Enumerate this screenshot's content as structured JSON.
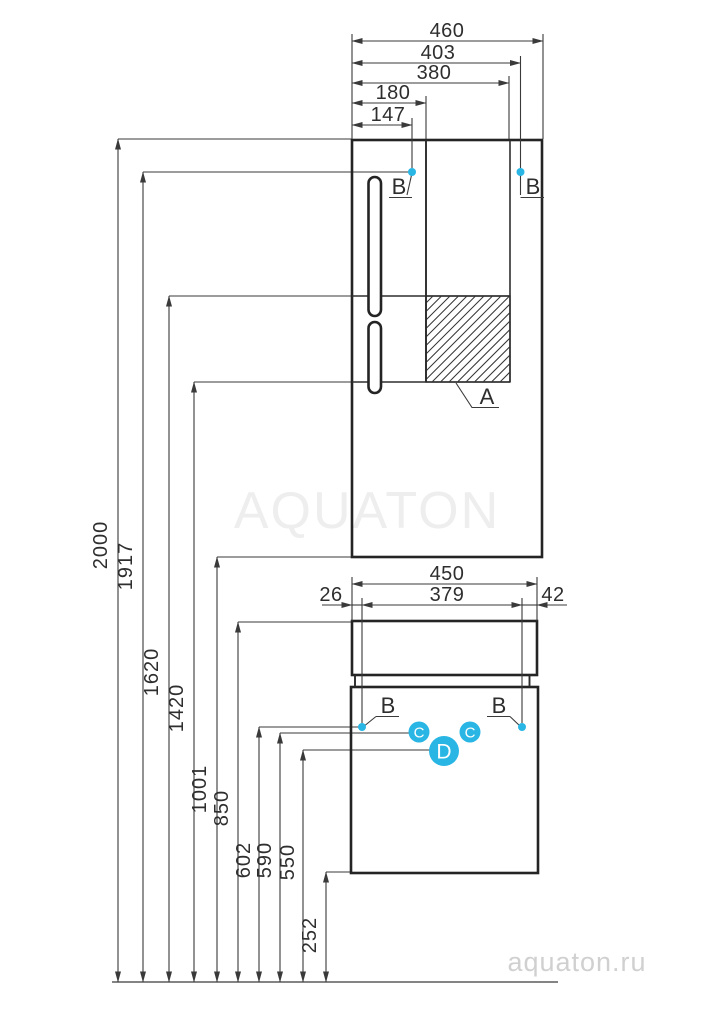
{
  "watermarks": {
    "brand": "AQUATON",
    "site": "aquaton.ru"
  },
  "colors": {
    "accent": "#29B6E4",
    "line_dark": "#242424",
    "line_thin": "#3A3A3A",
    "watermark_light": "#EEEEEE",
    "watermark_mid": "#D0D0D0"
  },
  "upper_cabinet": {
    "width_dims": {
      "total": "460",
      "to_right_hinge": "403",
      "inner": "380",
      "divider": "180",
      "to_left_hinge": "147"
    },
    "hinge_label_left": "B",
    "hinge_label_right": "B",
    "hatch_label": "A"
  },
  "lower_cabinet": {
    "width_dims": {
      "total": "450",
      "hinge_span": "379",
      "left_offset": "26",
      "right_offset": "42"
    },
    "hinge_label_left": "B",
    "hinge_label_right": "B",
    "marker_left": "C",
    "marker_right": "C",
    "marker_center": "D"
  },
  "height_dims": {
    "h2000": "2000",
    "h1917": "1917",
    "h1620": "1620",
    "h1420": "1420",
    "h1001": "1001",
    "h850": "850",
    "h602": "602",
    "h590": "590",
    "h550": "550",
    "h252": "252"
  }
}
